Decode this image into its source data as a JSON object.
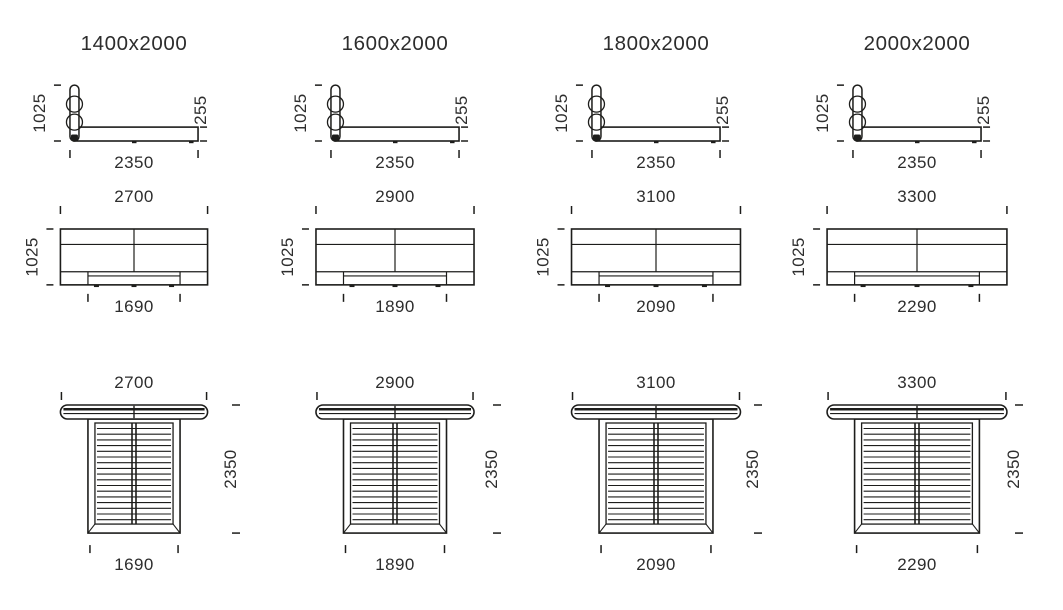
{
  "style": {
    "background": "#ffffff",
    "line_color": "#1d1d1b",
    "text_color": "#2d2d2d"
  },
  "scale_px_per_mm": 0.0545,
  "columns": [
    {
      "title": "1400x2000",
      "side_view": {
        "height": "1025",
        "base_height": "255",
        "length": "2350"
      },
      "front_view": {
        "width": "2700",
        "height": "1025",
        "base_width": "1690"
      },
      "top_view": {
        "width": "2700",
        "depth": "2350",
        "base_width": "1690"
      }
    },
    {
      "title": "1600x2000",
      "side_view": {
        "height": "1025",
        "base_height": "255",
        "length": "2350"
      },
      "front_view": {
        "width": "2900",
        "height": "1025",
        "base_width": "1890"
      },
      "top_view": {
        "width": "2900",
        "depth": "2350",
        "base_width": "1890"
      }
    },
    {
      "title": "1800x2000",
      "side_view": {
        "height": "1025",
        "base_height": "255",
        "length": "2350"
      },
      "front_view": {
        "width": "3100",
        "height": "1025",
        "base_width": "2090"
      },
      "top_view": {
        "width": "3100",
        "depth": "2350",
        "base_width": "2090"
      }
    },
    {
      "title": "2000x2000",
      "side_view": {
        "height": "1025",
        "base_height": "255",
        "length": "2350"
      },
      "front_view": {
        "width": "3300",
        "height": "1025",
        "base_width": "2290"
      },
      "top_view": {
        "width": "3300",
        "depth": "2350",
        "base_width": "2290"
      }
    }
  ]
}
